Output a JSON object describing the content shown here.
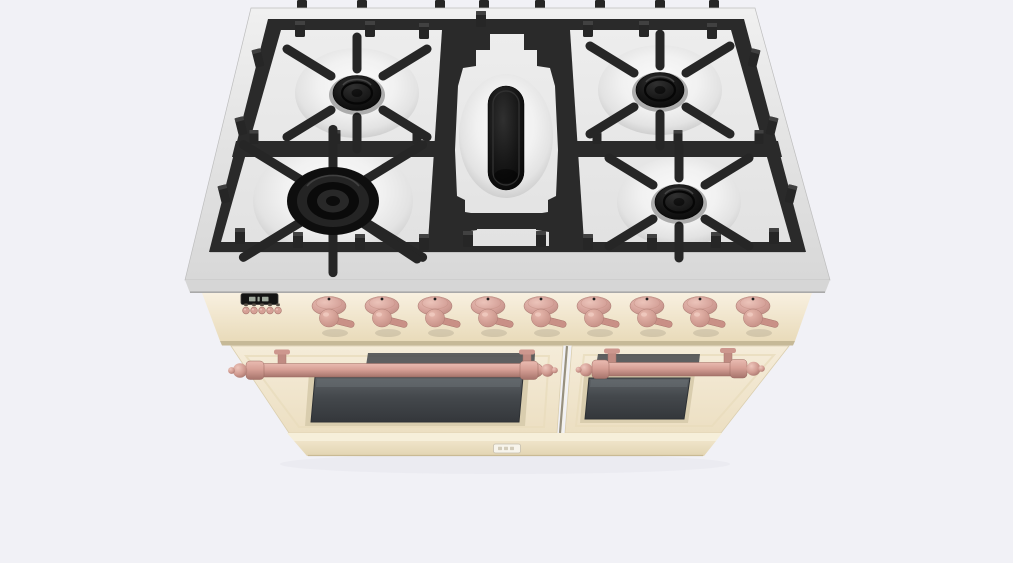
{
  "scene": {
    "type": "3d-product-render",
    "subject": "Freestanding double-oven gas range, antique-white finish with copper hardware, 5-burner cooktop, viewed from elevated front angle",
    "view": "front, elevated top-down perspective"
  },
  "colors": {
    "bg": "#f1f1f6",
    "rim": "#e4e4e4",
    "rim-face": "#d6d6d6",
    "rim-edge": "#a9a9a9",
    "tray": "#2a2a2a",
    "grate": "#262626",
    "grate-hi": "#474747",
    "grate-dark": "#151515",
    "floor": "#e9e9e9",
    "cream": "#f2e8d1",
    "cream-hi": "#f8f1e1",
    "cream-dark": "#e2d4b2",
    "cream-shadow": "#c6b997",
    "rose": "#d5a096",
    "rose-mid": "#c99086",
    "rose-dark": "#a8756d",
    "rose-hi": "#eec6bc",
    "window": "#43474b",
    "display": "#141414",
    "display-glow": "#aeb8ab",
    "badge": "#f7f4eb"
  },
  "cooktop": {
    "sections": 3,
    "grate_material": "cast-iron, castellated frames",
    "back_prongs": [
      302,
      362,
      440,
      484,
      540,
      600,
      660,
      714
    ],
    "edge_prongs": [
      {
        "x": 258,
        "y": 58,
        "r": -14
      },
      {
        "x": 241,
        "y": 126,
        "r": -14
      },
      {
        "x": 224,
        "y": 194,
        "r": -14
      },
      {
        "x": 754,
        "y": 58,
        "r": 14
      },
      {
        "x": 772,
        "y": 126,
        "r": 14
      },
      {
        "x": 791,
        "y": 194,
        "r": 14
      }
    ],
    "frame_tabs": [
      {
        "x": 481,
        "y": 11
      },
      {
        "x": 300,
        "y": 21
      },
      {
        "x": 370,
        "y": 21
      },
      {
        "x": 424,
        "y": 23
      },
      {
        "x": 588,
        "y": 21
      },
      {
        "x": 644,
        "y": 21
      },
      {
        "x": 712,
        "y": 23
      },
      {
        "x": 240,
        "y": 228
      },
      {
        "x": 298,
        "y": 232
      },
      {
        "x": 360,
        "y": 234
      },
      {
        "x": 424,
        "y": 234
      },
      {
        "x": 468,
        "y": 231
      },
      {
        "x": 541,
        "y": 231
      },
      {
        "x": 588,
        "y": 234
      },
      {
        "x": 652,
        "y": 234
      },
      {
        "x": 716,
        "y": 232
      },
      {
        "x": 774,
        "y": 228
      }
    ],
    "divider_stubs": [
      {
        "x": 254,
        "y": 130
      },
      {
        "x": 336,
        "y": 130
      },
      {
        "x": 417,
        "y": 130
      },
      {
        "x": 597,
        "y": 130
      },
      {
        "x": 678,
        "y": 130
      },
      {
        "x": 759,
        "y": 130
      }
    ],
    "burners": [
      {
        "name": "left-rear",
        "type": "standard",
        "section": "L",
        "cx": 357,
        "cy": 93
      },
      {
        "name": "right-rear",
        "type": "standard",
        "section": "R",
        "cx": 660,
        "cy": 90
      },
      {
        "name": "left-front",
        "type": "dual-ring",
        "section": "L",
        "cx": 333,
        "cy": 201
      },
      {
        "name": "right-front",
        "type": "standard",
        "section": "R",
        "cx": 679,
        "cy": 202
      },
      {
        "name": "center-oval",
        "type": "oval",
        "section": "C",
        "cx": 506,
        "cy": 138
      }
    ]
  },
  "control_panel": {
    "knob_row": {
      "count": 9,
      "y": 306,
      "xs": [
        329,
        382,
        435,
        488,
        541,
        594,
        647,
        700,
        753
      ]
    },
    "display": {
      "x": 241,
      "y": 293,
      "w": 37,
      "h": 11,
      "segments": 3
    },
    "buttons": {
      "count": 5,
      "y": 310.5,
      "xs": [
        246,
        254,
        262,
        270,
        278
      ],
      "icon_y": 303.5
    }
  },
  "oven": {
    "doors": 2,
    "handle_finish": "copper rail with ball finials",
    "window_count": 2
  },
  "kick_panel": {
    "badge_present": true
  }
}
